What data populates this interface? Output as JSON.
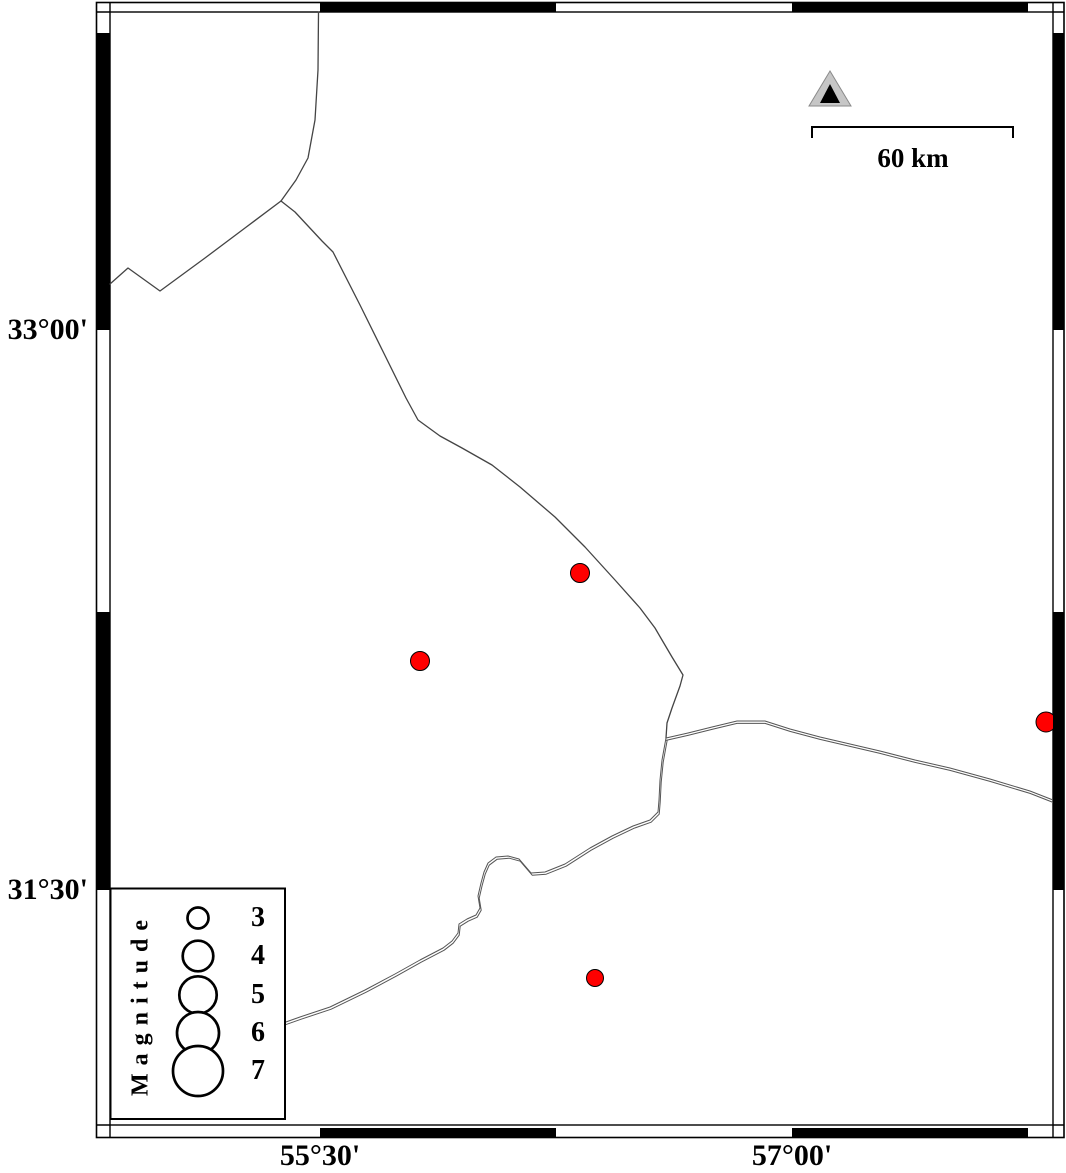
{
  "figure": {
    "title_semantic": "seismicity-map",
    "axis": {
      "lat_labels": [
        {
          "text": "33°00'",
          "y": 330
        },
        {
          "text": "31°30'",
          "y": 890
        }
      ],
      "lon_labels": [
        {
          "text": "55°30'",
          "x": 320
        },
        {
          "text": "57°00'",
          "x": 792
        }
      ]
    },
    "scale_bar": {
      "label": "60 km",
      "length_px": 201
    },
    "station": {
      "x": 830,
      "y": 90
    },
    "earthquakes": [
      {
        "x": 580,
        "y": 573,
        "r": 9.5
      },
      {
        "x": 420,
        "y": 661,
        "r": 9.5
      },
      {
        "x": 1046,
        "y": 722,
        "r": 10
      },
      {
        "x": 595,
        "y": 978,
        "r": 8.5
      }
    ],
    "colors": {
      "epicenter_fill": "#ff0000",
      "epicenter_stroke": "#000000",
      "station_fill": "#c6c6c6",
      "station_edge": "#8a8a8a",
      "station_inner": "#000000",
      "boundary_line": "#444444",
      "frame": "#000000"
    }
  },
  "legend": {
    "title": "Magnitude",
    "circle_cx": 198,
    "entries": [
      {
        "label": "3",
        "r": 10.5,
        "cy": 918
      },
      {
        "label": "4",
        "r": 15.3,
        "cy": 956
      },
      {
        "label": "5",
        "r": 18.7,
        "cy": 995
      },
      {
        "label": "6",
        "r": 21.0,
        "cy": 1033
      },
      {
        "label": "7",
        "r": 25.0,
        "cy": 1071
      }
    ]
  }
}
